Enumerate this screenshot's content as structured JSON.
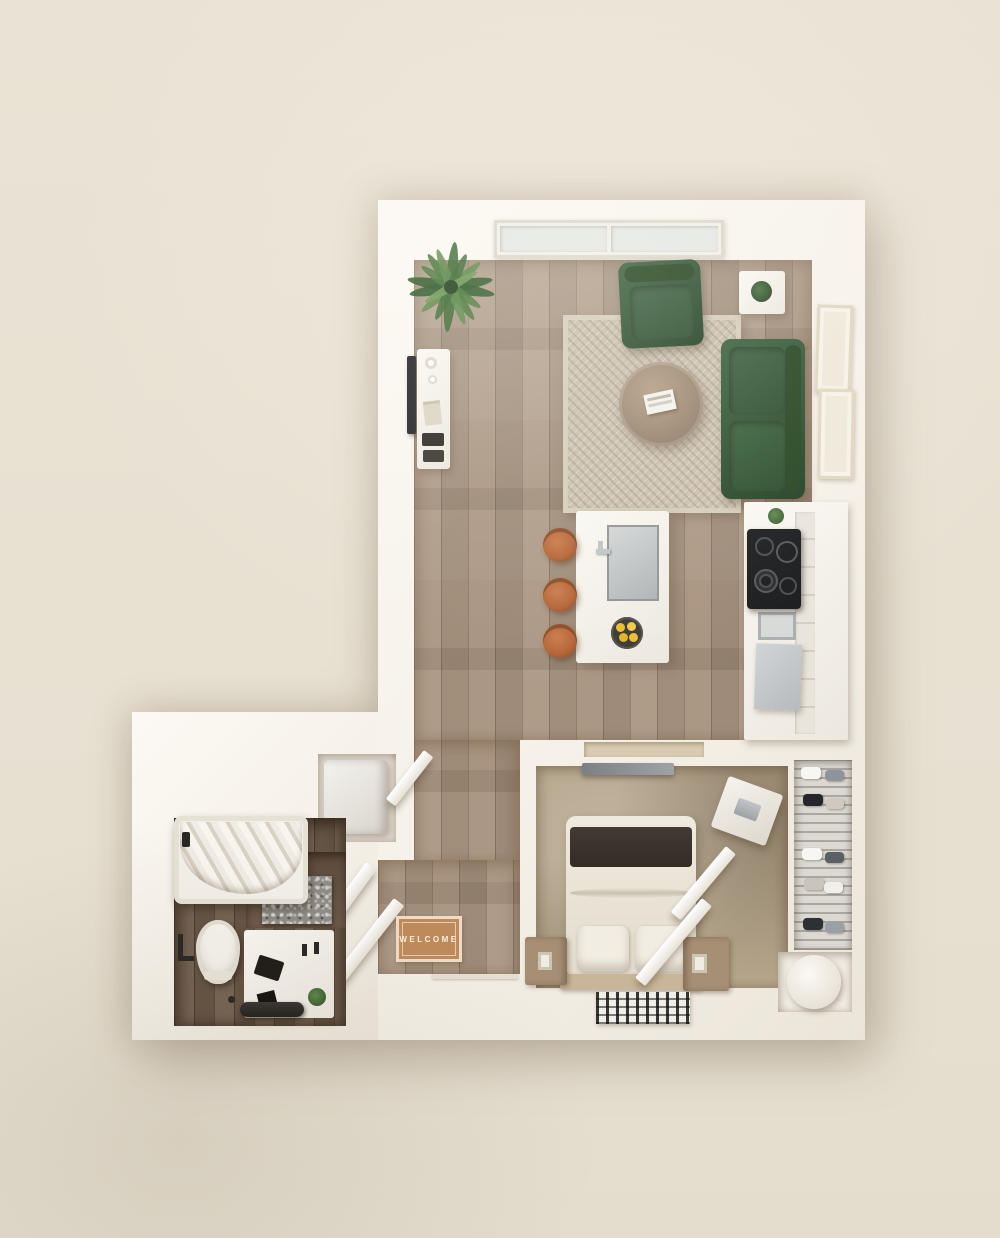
{
  "scene": {
    "type": "3d-floor-plan-render",
    "description": "top-down studio apartment floor plan"
  },
  "labels": {
    "welcome_mat": "WELCOME"
  },
  "palette": {
    "background": "#eae3d5",
    "wall": "#f5f1e8",
    "wood_floor": "#a5907b",
    "bath_floor": "#6e5c4b",
    "carpet": "#b6a78d",
    "rug": "#cbc0ad",
    "sofa_green": "#2e5132",
    "stool_leather": "#b56436",
    "mat_tan": "#c08b5b",
    "lemon_yellow": "#ecbe2d",
    "cooktop_black": "#1a1b1d",
    "marble_gray": "#908c86",
    "frame_cream": "#efe8da",
    "nightstand_wood": "#a68f75",
    "headboard_tan": "#c8b69a"
  },
  "rooms": [
    {
      "name": "living-room",
      "furniture": [
        "green-sofa",
        "green-armchair",
        "round-coffee-table",
        "area-rug",
        "tv-console",
        "wall-tv",
        "side-table-with-plant",
        "palm-plant",
        "picture-frame",
        "picture-frame",
        "window"
      ]
    },
    {
      "name": "kitchen",
      "furniture": [
        "island-with-sink",
        "bar-stool",
        "bar-stool",
        "bar-stool",
        "lemon-bowl",
        "cooktop",
        "built-in-appliance",
        "refrigerator",
        "cabinet-run"
      ]
    },
    {
      "name": "bedroom",
      "furniture": [
        "double-bed",
        "pillow",
        "pillow",
        "dark-throw",
        "headboard-bench",
        "nightstand",
        "nightstand",
        "wall-tv",
        "accent-rug",
        "fold-down-desk",
        "closet-door-leaf",
        "shoe-closet",
        "round-side-chair"
      ]
    },
    {
      "name": "bathroom",
      "furniture": [
        "bathtub-shower",
        "shower-curtain",
        "marble-backsplash",
        "toilet",
        "vanity",
        "towel-bar",
        "plant"
      ]
    },
    {
      "name": "entry-hall",
      "furniture": [
        "welcome-mat",
        "door-leaf",
        "door-leaf",
        "laundry-closet",
        "washer-dryer"
      ]
    }
  ]
}
